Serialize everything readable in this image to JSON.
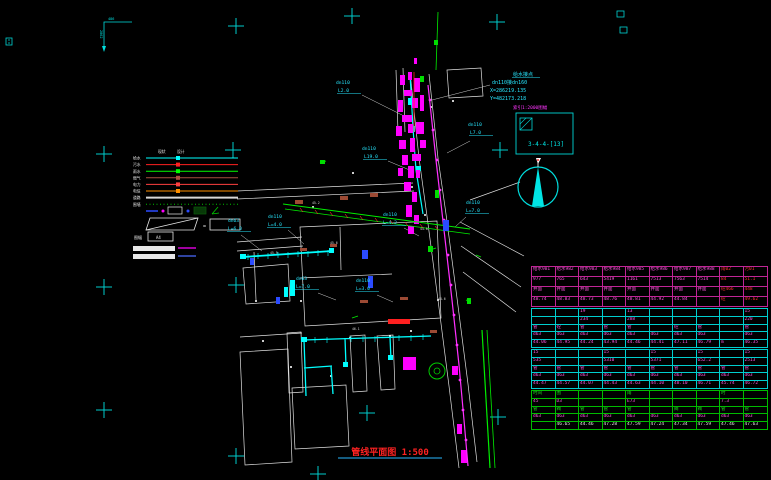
{
  "title": {
    "text": "管线平面图 1:500"
  },
  "corner_mark": {
    "text_h": "486",
    "text_v": "2862"
  },
  "annotation": {
    "title": "给水接点",
    "line1": "dn110接dn160",
    "line2": "X=286219.135",
    "line3": "Y=482173.218"
  },
  "index_box": {
    "label": "索引1:2000图幅",
    "sheet": "3-4-4-[13]"
  },
  "legend": {
    "headers": [
      "现状",
      "设计"
    ],
    "rows": [
      {
        "label": "给水",
        "color": "#00ffff"
      },
      {
        "label": "污水",
        "color": "#ff2020"
      },
      {
        "label": "雨水",
        "color": "#00ff00"
      },
      {
        "label": "燃气",
        "color": "#a85040"
      },
      {
        "label": "电力",
        "color": "#ff4040"
      },
      {
        "label": "电信",
        "color": "#ff9000"
      },
      {
        "label": "道路",
        "color": "#d8d8d8",
        "thick": 2
      },
      {
        "label": "围墙",
        "color": "#00c000",
        "dotted": 1
      }
    ],
    "eq": "=",
    "scale_label": "图幅",
    "scale_value": "A4"
  },
  "map": {
    "labels": [
      {
        "x": 336,
        "y": 84,
        "t": "dn110"
      },
      {
        "x": 338,
        "y": 92,
        "t": "L2.0",
        "u": 1
      },
      {
        "x": 362,
        "y": 150,
        "t": "dn110"
      },
      {
        "x": 364,
        "y": 158,
        "t": "L19.0",
        "u": 1
      },
      {
        "x": 468,
        "y": 126,
        "t": "dn110"
      },
      {
        "x": 470,
        "y": 134,
        "t": "L7.0",
        "u": 1
      },
      {
        "x": 228,
        "y": 222,
        "t": "dn63"
      },
      {
        "x": 228,
        "y": 230,
        "t": "L=6.0",
        "u": 1
      },
      {
        "x": 268,
        "y": 218,
        "t": "dn110"
      },
      {
        "x": 268,
        "y": 226,
        "t": "L=4.0",
        "u": 1
      },
      {
        "x": 383,
        "y": 216,
        "t": "dn110"
      },
      {
        "x": 383,
        "y": 224,
        "t": "L=4.2",
        "u": 1
      },
      {
        "x": 466,
        "y": 204,
        "t": "dn110"
      },
      {
        "x": 466,
        "y": 212,
        "t": "L=7.0",
        "u": 1
      },
      {
        "x": 296,
        "y": 280,
        "t": "dn63"
      },
      {
        "x": 296,
        "y": 288,
        "t": "L=7.0",
        "u": 1
      },
      {
        "x": 356,
        "y": 282,
        "t": "dn110"
      },
      {
        "x": 356,
        "y": 290,
        "t": "L=3.0",
        "u": 1
      },
      {
        "x": 312,
        "y": 204,
        "t": "45.2",
        "c": "#dddddd",
        "s": 3.2
      },
      {
        "x": 420,
        "y": 230,
        "t": "44.8",
        "c": "#dddddd",
        "s": 3.2
      },
      {
        "x": 330,
        "y": 244,
        "t": "45.6",
        "c": "#dddddd",
        "s": 3.2
      },
      {
        "x": 352,
        "y": 330,
        "t": "46.1",
        "c": "#dddddd",
        "s": 3.2
      },
      {
        "x": 270,
        "y": 254,
        "t": "45.9",
        "c": "#dddddd",
        "s": 3.2
      },
      {
        "x": 438,
        "y": 300,
        "t": "44.6",
        "c": "#dddddd",
        "s": 3.2
      }
    ]
  },
  "table": {
    "sections": [
      {
        "cls": "sec-a",
        "rows": [
          {
            "cls": "row-m",
            "cells": [
              "给水981",
              "给水982",
              "给水983",
              "给水984",
              "给水985",
              "给水986",
              "给水987",
              "给水988",
              "雨02",
              "污01"
            ]
          },
          {
            "cls": "row-m",
            "cells": [
              "977",
              "765",
              "643",
              "5419",
              "1161",
              "7513",
              "7563",
              "7514",
              "84",
              "51.1"
            ]
          },
          {
            "cls": "row-m",
            "cells": [
              "井面",
              "井面",
              "井面",
              "井面",
              "井面",
              "井面",
              "井面",
              "井面",
              "砼466",
              "448"
            ]
          },
          {
            "cls": "row-m",
            "cells": [
              "48.74",
              "48.83",
              "48.73",
              "48.76",
              "48.81",
              "44.92",
              "44.84",
              "",
              "砼",
              "49.62"
            ]
          }
        ]
      },
      {
        "cls": "sec-b",
        "rows": [
          {
            "cls": "row-m",
            "cells": [
              "",
              "",
              "19",
              "",
              "13",
              "",
              "",
              "",
              "",
              "15"
            ]
          },
          {
            "cls": "row-m",
            "cells": [
              "",
              "",
              "234",
              "",
              "288",
              "",
              "",
              "",
              "",
              "220"
            ]
          },
          {
            "cls": "row-m",
            "cells": [
              "管",
              "砼",
              "管",
              "管",
              "管",
              "",
              "砼",
              "管",
              "",
              "管"
            ]
          },
          {
            "cls": "row-m",
            "cells": [
              "d63",
              "d63",
              "d63",
              "d63",
              "d63",
              "d63",
              "d63",
              "d63",
              "",
              "d63"
            ]
          },
          {
            "cls": "row-m",
            "cells": [
              "44.06",
              "44.95",
              "44.24",
              "43.94",
              "44.46",
              "44.41",
              "47.11",
              "46.79",
              "m",
              "46.35"
            ]
          }
        ]
      },
      {
        "cls": "sec-c",
        "rows": [
          {
            "cls": "row-m",
            "cells": [
              "15",
              "",
              "",
              "15",
              "",
              "15",
              "",
              "15",
              "",
              "15"
            ]
          },
          {
            "cls": "row-m",
            "cells": [
              "535",
              "",
              "",
              "5310",
              "",
              "5371",
              "",
              "652.2",
              "",
              "2513"
            ]
          },
          {
            "cls": "row-m",
            "cells": [
              "管",
              "管",
              "管",
              "管",
              "管",
              "管",
              "管",
              "管",
              "管",
              "管"
            ]
          },
          {
            "cls": "row-m",
            "cells": [
              "d63",
              "d63",
              "d63",
              "d63",
              "d63",
              "d63",
              "d63",
              "d63",
              "d63",
              "d63"
            ]
          },
          {
            "cls": "row-m",
            "cells": [
              "44.47",
              "44.57",
              "44.07",
              "44.43",
              "44.63",
              "44.10",
              "48.10",
              "46.71",
              "45.74",
              "46.72"
            ]
          }
        ]
      },
      {
        "cls": "sec-d",
        "rows": [
          {
            "cls": "row-g",
            "cells": [
              "时间",
              "围",
              "",
              "",
              "雨",
              "",
              "",
              "",
              "时",
              ""
            ]
          },
          {
            "cls": "row-m",
            "cells": [
              "45",
              "D3",
              "",
              "",
              "E73",
              "",
              "",
              "",
              "7.3",
              ""
            ]
          },
          {
            "cls": "row-g",
            "cells": [
              "管",
              "阀",
              "管",
              "管",
              "管",
              "",
              "阀",
              "阀",
              "管",
              "管"
            ]
          },
          {
            "cls": "row-m",
            "cells": [
              "d63",
              "d63",
              "d63",
              "d63",
              "d63",
              "d63",
              "d63",
              "d63",
              "d63",
              "d63"
            ]
          },
          {
            "cls": "row-w",
            "cells": [
              "",
              "46.65",
              "44.46",
              "47.28",
              "47.59",
              "47.24",
              "47.34",
              "47.59",
              "47.46",
              "47.63"
            ]
          }
        ]
      }
    ]
  }
}
